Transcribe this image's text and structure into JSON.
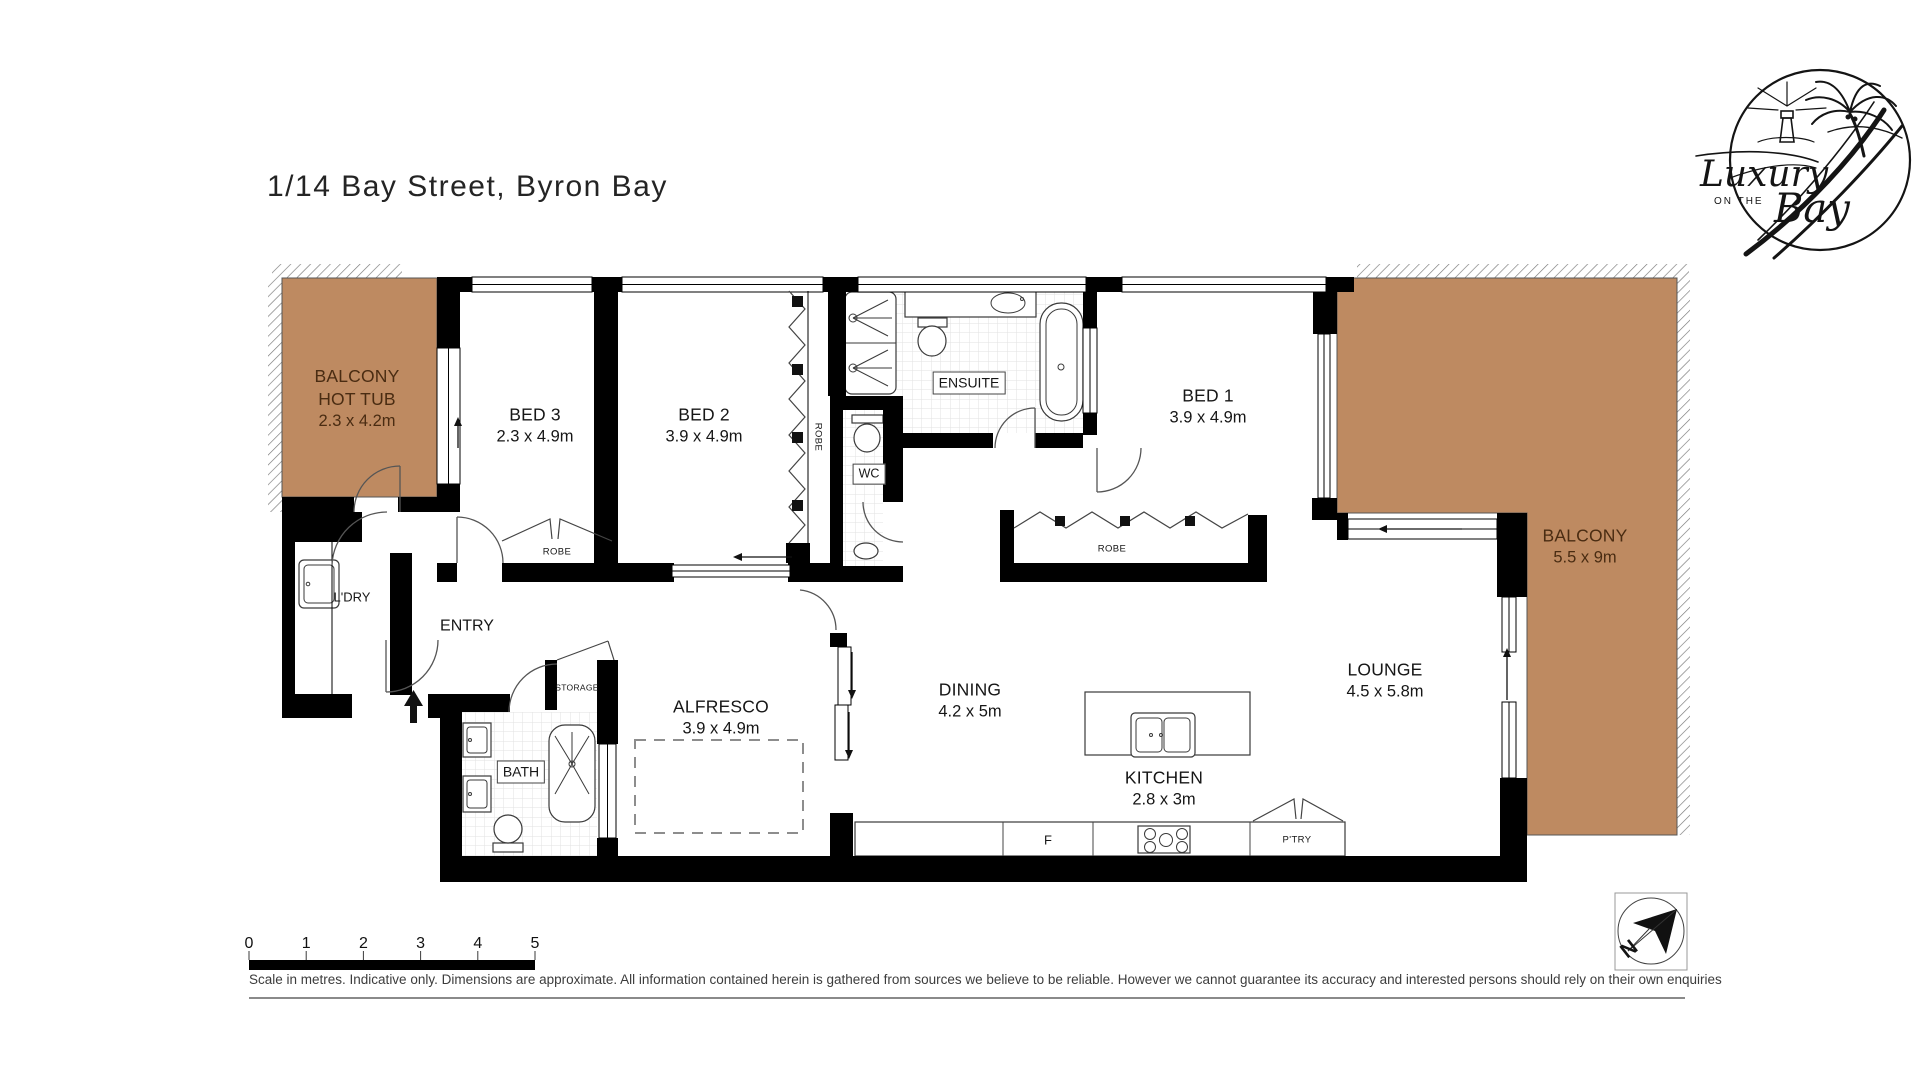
{
  "title": "1/14 Bay Street, Byron Bay",
  "logo": {
    "word1": "Luxury",
    "word2": "ON THE",
    "word3": "Bay"
  },
  "rooms": {
    "balcony_hot_tub": {
      "line1": "BALCONY",
      "line2": "HOT TUB",
      "dims": "2.3 x 4.2m"
    },
    "bed3": {
      "name": "BED 3",
      "dims": "2.3 x 4.9m"
    },
    "bed2": {
      "name": "BED 2",
      "dims": "3.9 x 4.9m"
    },
    "bed1": {
      "name": "BED 1",
      "dims": "3.9 x 4.9m"
    },
    "ensuite": {
      "name": "ENSUITE"
    },
    "wc": {
      "name": "WC"
    },
    "balcony": {
      "name": "BALCONY",
      "dims": "5.5 x 9m"
    },
    "laundry": {
      "name": "L'DRY"
    },
    "entry": {
      "name": "ENTRY"
    },
    "storage": {
      "name": "STORAGE"
    },
    "bath": {
      "name": "BATH"
    },
    "alfresco": {
      "name": "ALFRESCO",
      "dims": "3.9 x 4.9m"
    },
    "dining": {
      "name": "DINING",
      "dims": "4.2 x 5m"
    },
    "kitchen": {
      "name": "KITCHEN",
      "dims": "2.8 x 3m"
    },
    "lounge": {
      "name": "LOUNGE",
      "dims": "4.5 x 5.8m"
    }
  },
  "fixtures": {
    "robe_bed3": "ROBE",
    "robe_bed2": "ROBE",
    "robe_bed1": "ROBE",
    "fridge": "F",
    "pantry": "P'TRY"
  },
  "scale_bar": {
    "ticks": [
      "0",
      "1",
      "2",
      "3",
      "4",
      "5"
    ]
  },
  "disclaimer": "Scale in metres. Indicative only. Dimensions are approximate. All information contained herein is gathered from sources we believe to be reliable. However we cannot guarantee its accuracy and interested persons should rely on their own enquiries",
  "compass": {
    "north_label": "N"
  },
  "colors": {
    "balcony_fill": "#BE8A61",
    "balcony_text": "#4A2C12",
    "wall": "#000000"
  }
}
